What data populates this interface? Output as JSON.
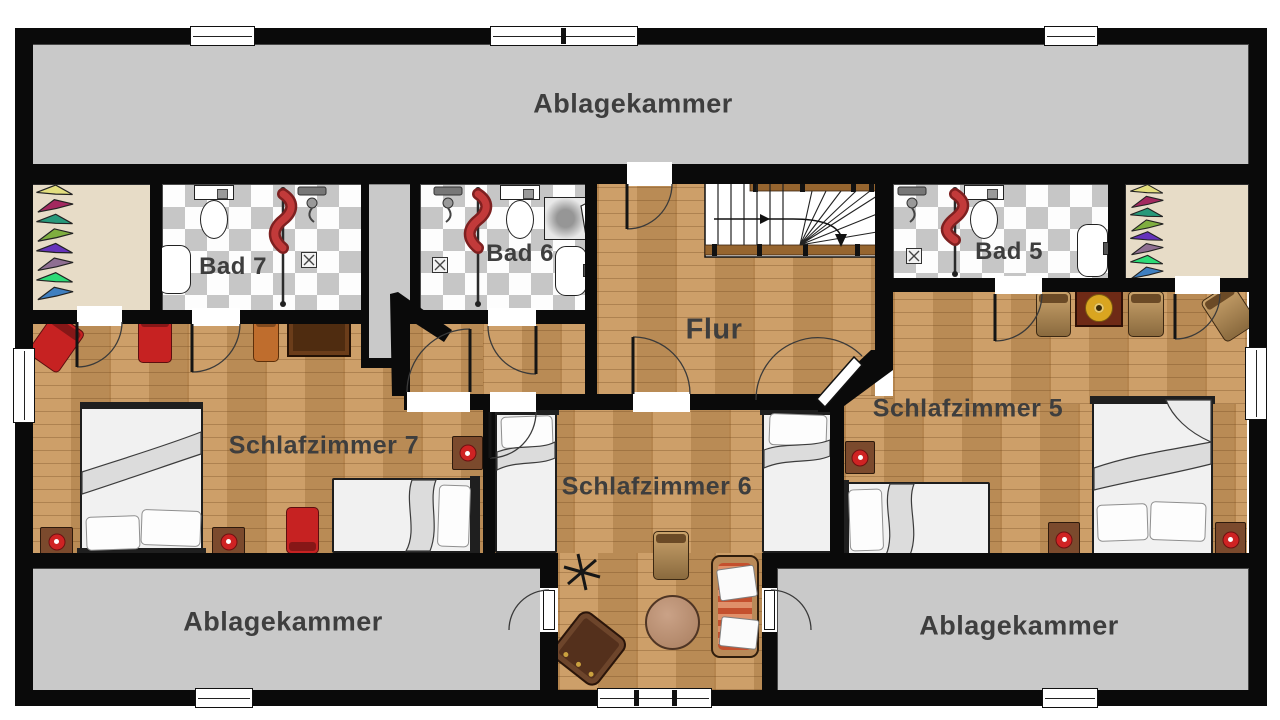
{
  "floorplan": {
    "rooms": {
      "storage_top": {
        "label": "Ablagekammer"
      },
      "bath7": {
        "label": "Bad 7"
      },
      "bath6": {
        "label": "Bad 6"
      },
      "bath5": {
        "label": "Bad 5"
      },
      "hallway": {
        "label": "Flur"
      },
      "bedroom7": {
        "label": "Schlafzimmer 7"
      },
      "bedroom6": {
        "label": "Schlafzimmer 6"
      },
      "bedroom5": {
        "label": "Schlafzimmer 5"
      },
      "storage_bottom_left": {
        "label": "Ablagekammer"
      },
      "storage_bottom_right": {
        "label": "Ablagekammer"
      }
    },
    "colors": {
      "wall": "#0a0a0a",
      "wood_floor": "#c9975c",
      "tile_gray": "#c6c6c6",
      "storage_gray": "#c9c9c9",
      "closet_beige": "#e7dcc7",
      "label_text": "#3e3e3e",
      "accent_red": "#c62222",
      "towel_red": "#c23a3a",
      "sofa_stripe": "#c4502e",
      "table_gold": "#d9a520"
    },
    "hanger_colors": [
      "#e3de7e",
      "#a3285f",
      "#27997a",
      "#7fae3f",
      "#6633bb",
      "#8f6f92",
      "#2ddb76",
      "#3f7fc0"
    ]
  }
}
